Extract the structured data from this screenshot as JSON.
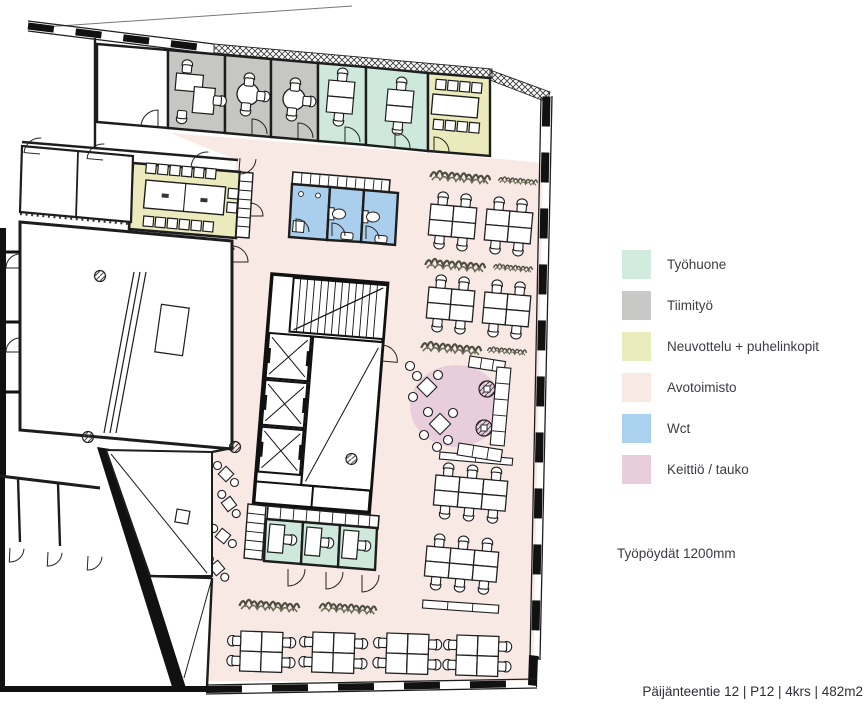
{
  "legend": {
    "items": [
      {
        "label": "Työhuone",
        "color": "#d2ebdf"
      },
      {
        "label": "Tiimityö",
        "color": "#c8c8c6"
      },
      {
        "label": "Neuvottelu + puhelinkopit",
        "color": "#ebecbe"
      },
      {
        "label": "Avotoimisto",
        "color": "#f9e9e4"
      },
      {
        "label": "Wct",
        "color": "#aad2ee"
      },
      {
        "label": "Keittiö / tauko",
        "color": "#e8cedb"
      }
    ]
  },
  "notes": {
    "desks": "Työpöydät 1200mm"
  },
  "footer": {
    "address": "Päijänteentie 12 | P12 | 4krs | 482m2"
  },
  "floor_plan": {
    "zone_colors": {
      "tyohuone": "#cfe8dc",
      "tiimityo": "#c6c6c3",
      "neuvottelu": "#eaeabc",
      "avotoimisto": "#f9e9e4",
      "wct": "#aacfec",
      "keittio": "#e8cedc"
    }
  }
}
